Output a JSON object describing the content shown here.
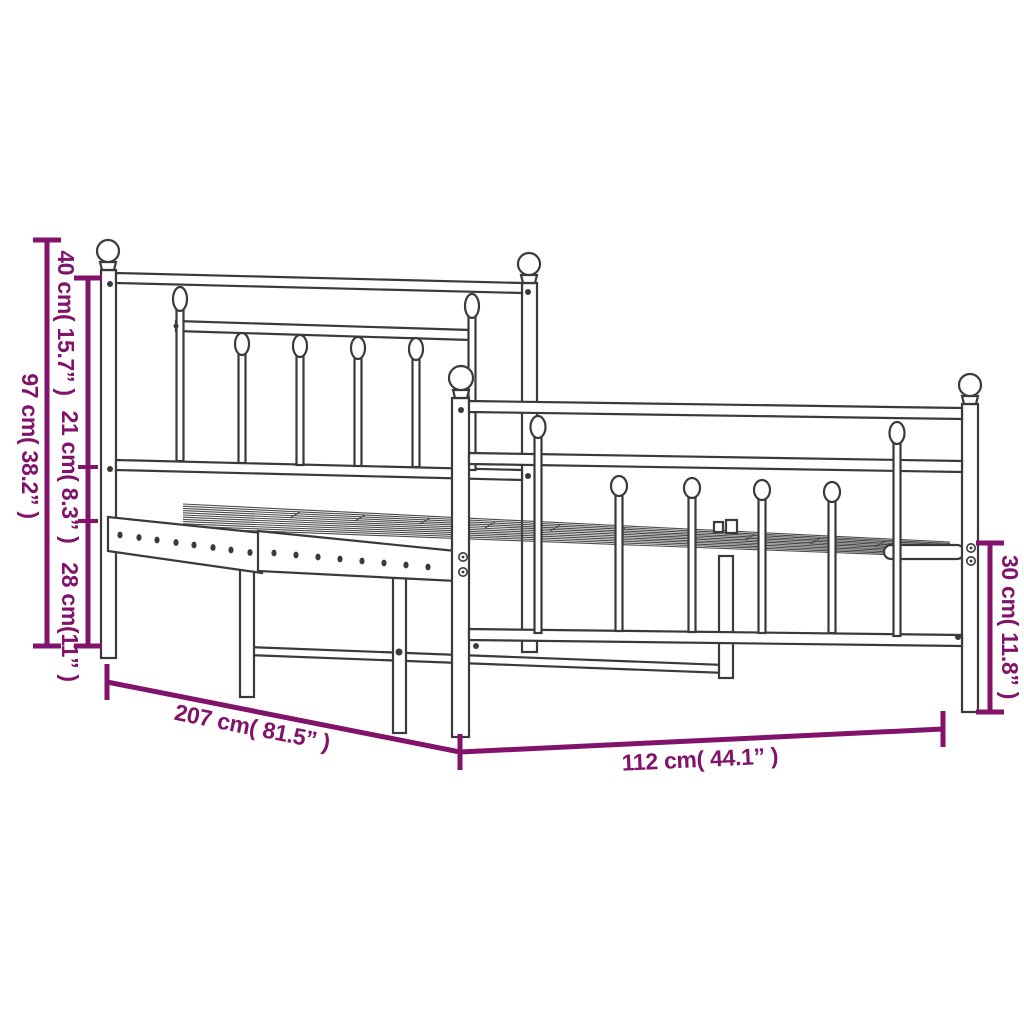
{
  "page": {
    "background": "#ffffff"
  },
  "diagram": {
    "type": "furniture-dimension-diagram",
    "subject": "metal bed frame with headboard and footboard",
    "colors": {
      "dimension": "#81136B",
      "drawing_outline": "#3a3a3a",
      "fill": "#ffffff"
    },
    "labels": {
      "overall_height": "97 cm( 38.2” )",
      "headboard_upper": "40 cm( 15.7” )",
      "headboard_middle": "21 cm( 8.3” )",
      "headboard_lower": "28 cm(11” )",
      "frame_length": "207 cm( 81.5” )",
      "frame_width": "112 cm( 44.1” )",
      "footboard_height": "30 cm( 11.8” )"
    }
  }
}
